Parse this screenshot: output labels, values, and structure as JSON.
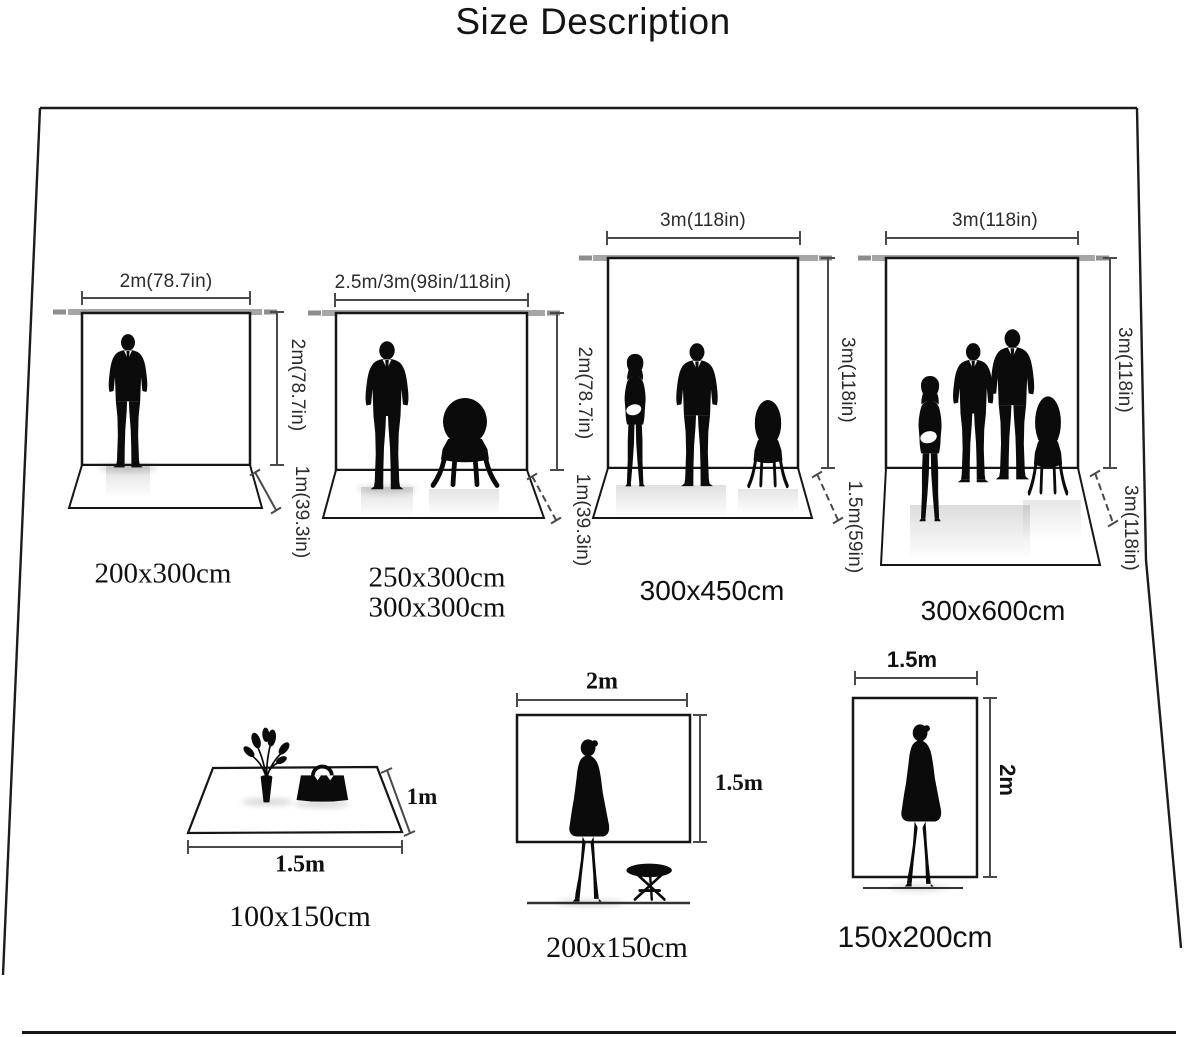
{
  "title": "Size Description",
  "backdrops": [
    {
      "width_label": "2m(78.7in)",
      "height_label": "2m(78.7in)",
      "depth_label": "1m(39.3in)",
      "size_label": "200x300cm"
    },
    {
      "width_label": "2.5m/3m(98in/118in)",
      "height_label": "2m(78.7in)",
      "depth_label": "1m(39.3in)",
      "size_label": "250x300cm",
      "size_label_2": "300x300cm"
    },
    {
      "width_label": "3m(118in)",
      "height_label": "3m(118in)",
      "depth_label": "1.5m(59in)",
      "size_label": "300x450cm"
    },
    {
      "width_label": "3m(118in)",
      "height_label": "3m(118in)",
      "depth_label": "3m(118in)",
      "size_label": "300x600cm"
    }
  ],
  "floor_mat": {
    "width_label": "1.5m",
    "depth_label": "1m",
    "size_label": "100x150cm"
  },
  "small_backdrops": [
    {
      "width_label": "2m",
      "height_label": "1.5m",
      "size_label": "200x150cm"
    },
    {
      "width_label": "1.5m",
      "height_label": "2m",
      "size_label": "150x200cm"
    }
  ],
  "icons": {
    "man": "man-suit-silhouette",
    "woman_long_hair": "woman-long-hair-silhouette",
    "woman_dress": "woman-dress-silhouette",
    "chair": "balloon-back-chair-silhouette",
    "stool": "folding-stool-silhouette",
    "flowers": "flower-vase-silhouette",
    "handbag": "handbag-silhouette"
  },
  "colors": {
    "ink": "#1a1a1a",
    "dimension_line": "#4a4a4a",
    "crossbar_grey": "#a6a6a6",
    "crossbar_tip_grey": "#8d8d8d",
    "background": "#ffffff"
  }
}
